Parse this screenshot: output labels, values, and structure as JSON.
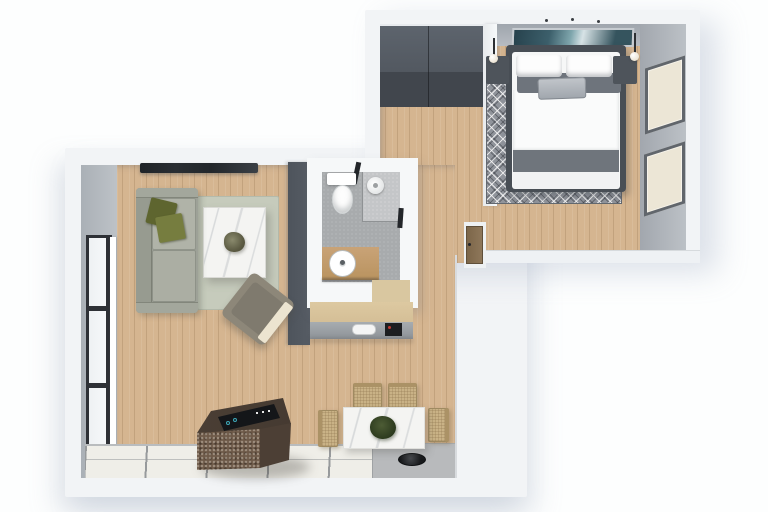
{
  "scene": {
    "type": "3d-floor-plan-top-view",
    "rooms": [
      {
        "name": "bedroom",
        "furniture": [
          "double-bed",
          "nightstand-left",
          "nightstand-right",
          "pendant-lamp-left",
          "pendant-lamp-right",
          "wall-art",
          "patterned-area-rug",
          "window-east-upper",
          "window-east-lower"
        ]
      },
      {
        "name": "entry-hall",
        "furniture": [
          "wardrobe",
          "entry-door"
        ]
      },
      {
        "name": "bathroom",
        "furniture": [
          "toilet",
          "shower-head",
          "glass-partition",
          "vanity-with-round-sink"
        ]
      },
      {
        "name": "kitchen",
        "furniture": [
          "island-with-cooktop",
          "counter",
          "oven",
          "white-appliance",
          "tile-floor",
          "black-bowl"
        ]
      },
      {
        "name": "living-room",
        "furniture": [
          "sofa",
          "olive-throw-pillows",
          "sage-rug",
          "marble-coffee-table",
          "potted-plant",
          "armchair-with-throw",
          "wall-tv",
          "window-west"
        ]
      },
      {
        "name": "dining-area",
        "furniture": [
          "marble-dining-table",
          "centerpiece-plant",
          "dining-chair-1",
          "dining-chair-2",
          "dining-chair-3",
          "dining-chair-4"
        ]
      }
    ],
    "counts": {
      "dining_chairs": 4,
      "east_windows": 2,
      "bed_pillows": 2,
      "sofa_throw_pillows": 2
    }
  },
  "palette": {
    "wood": "#d5b590",
    "wallWhite": "#f2f4f6",
    "wallGrey": "#aab0b6",
    "wallDark": "#565c64",
    "rugBed": "#90949b",
    "rugLiving": "#c6cbbc",
    "sofa": "#9da197",
    "olive": "#5e652f",
    "marble": "#f4f4f2",
    "islandTop": "#453a31",
    "islandFront": "#6e5a49",
    "counterWood": "#ddc9a1",
    "tile": "#efeee8",
    "bathFloor": "#a8abad",
    "bedGrey": "#6f757c",
    "artTeal": "#3c5f6b",
    "chairTan": "#c9b286",
    "doorBrown": "#8e775a",
    "tvDark": "#2a2e33",
    "floorGrey": "#b8babc",
    "windowCream": "#ece6d6",
    "frameDark": "#2e3136"
  }
}
